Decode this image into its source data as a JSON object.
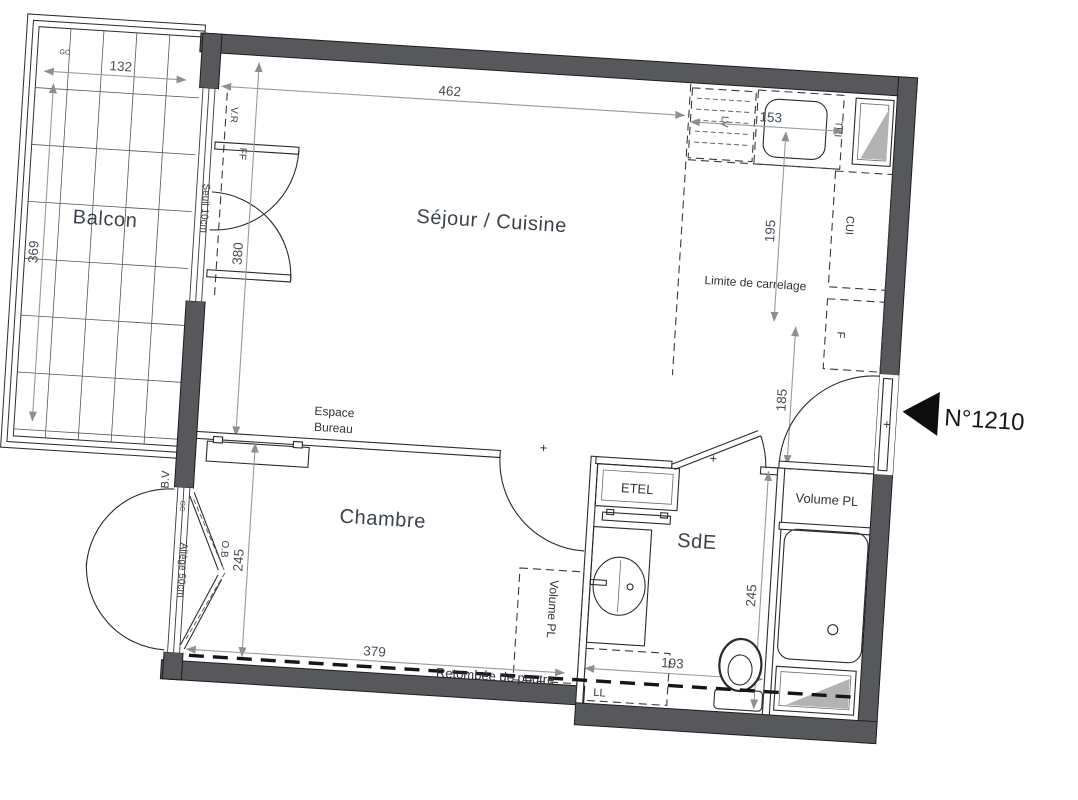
{
  "plan": {
    "unit_number": "N°1210",
    "rooms": {
      "balcony": "Balcon",
      "living": "Séjour / Cuisine",
      "bedroom": "Chambre",
      "shower_room": "SdE"
    },
    "annotations": {
      "seuil": "Seuil 10cm",
      "vr": "V.R",
      "ff": "FF",
      "bv": "B.V",
      "gc": "GC",
      "allege": "Allège 50cm",
      "ob": "O.B",
      "espace_line1": "Espace",
      "espace_line2": "Bureau",
      "limite": "Limite de carrelage",
      "retombee": "Retombée de poutre",
      "etel": "ETEL",
      "ll": "LL",
      "lv": "LV",
      "tri": "TRI",
      "cui": "CUI",
      "f": "F",
      "volume_pl_entry": "Volume PL",
      "volume_pl_bedroom": "Volume PL",
      "plus": "+"
    },
    "dims": {
      "balcony_width": "132",
      "balcony_depth": "369",
      "living_door": "380",
      "living_width": "462",
      "kitchen_width": "153",
      "kitchen_depth": "195",
      "hall_depth": "185",
      "bedroom_width": "379",
      "bedroom_depth": "245",
      "shower_width": "193",
      "shower_depth": "245"
    },
    "colors": {
      "wall": "#57585c",
      "glass": "#b3b3b3",
      "line": "#2b2b2b",
      "dim": "#9a9a9a"
    }
  }
}
